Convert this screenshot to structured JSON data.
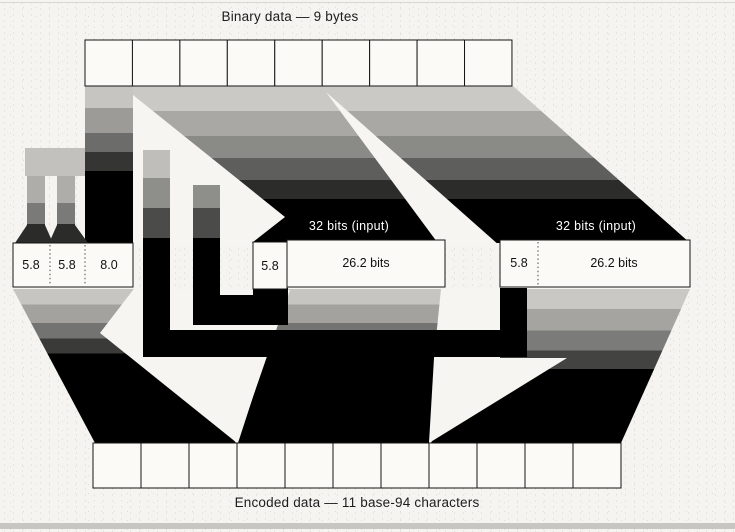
{
  "diagram": {
    "top_label": "Binary data — 9 bytes",
    "bottom_label": "Encoded data — 11 base-94 characters",
    "top_row": {
      "semantic": "binary-bytes",
      "cell_count": 9
    },
    "bottom_row": {
      "semantic": "encoded-characters",
      "cell_count": 11
    },
    "groups": {
      "left": {
        "cells": [
          "5.8",
          "5.8",
          "8.0"
        ]
      },
      "middle": {
        "header": "32 bits (input)",
        "cells": [
          "5.8",
          "26.2 bits"
        ]
      },
      "right": {
        "header": "32 bits (input)",
        "cells": [
          "5.8",
          "26.2 bits"
        ]
      }
    },
    "colors": {
      "paper": "#f5f4f1",
      "ink": "#161616",
      "band_light": "#cac9c5",
      "band_dark": "#000000"
    }
  }
}
